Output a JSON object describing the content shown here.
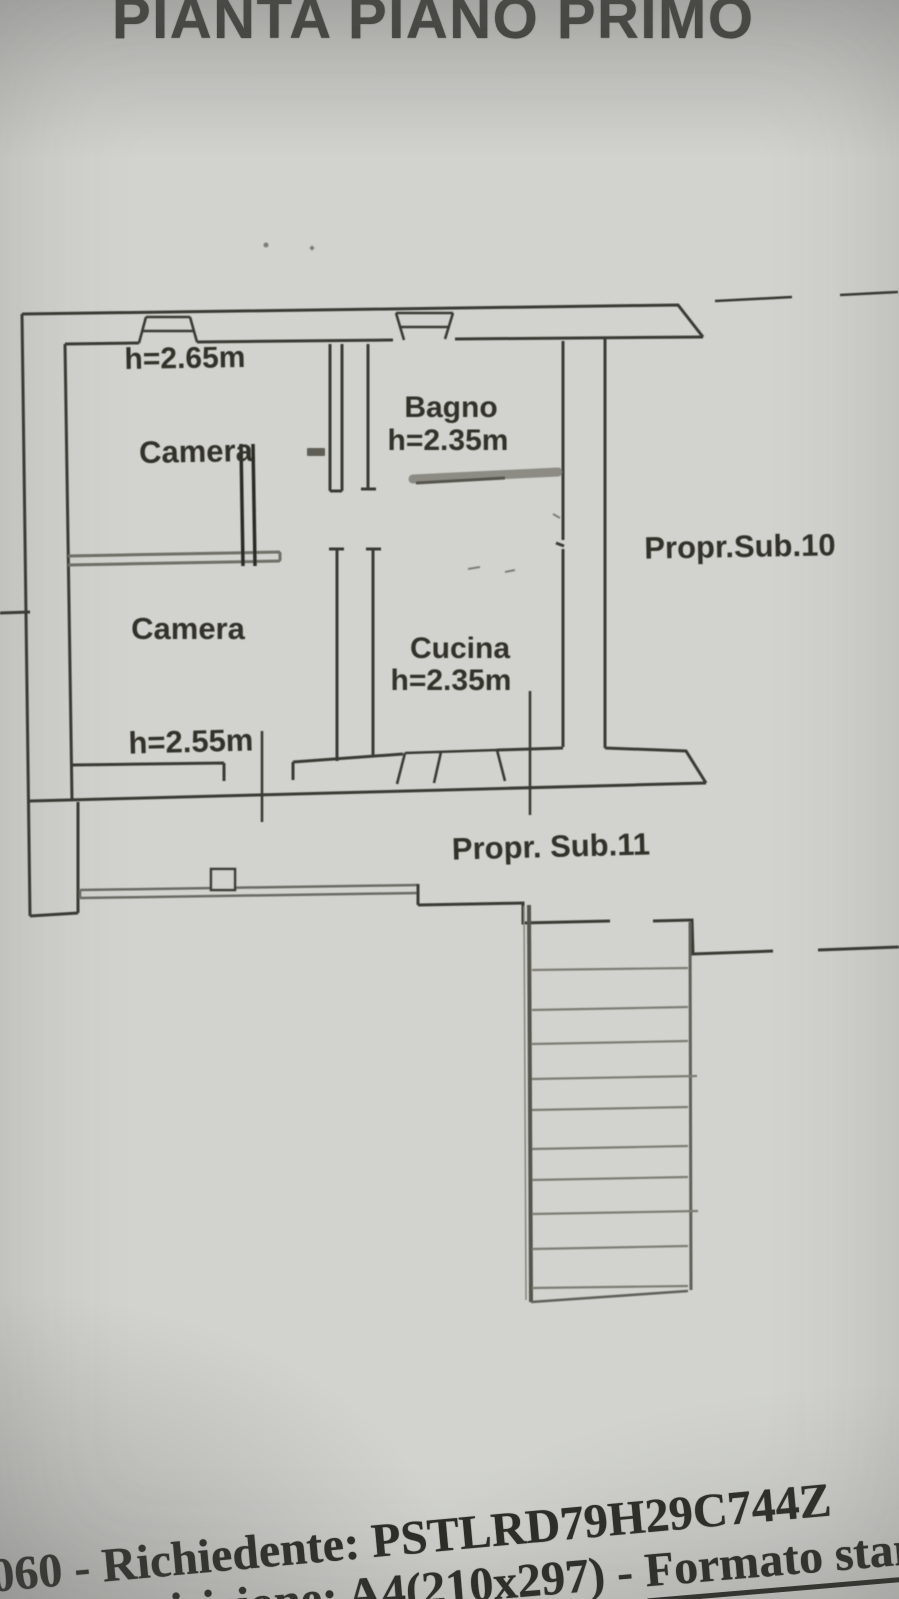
{
  "document": {
    "title": "PIANTA PIANO PRIMO",
    "footer": {
      "line1": "060 - Richiedente: PSTLRD79H29C744Z",
      "line2_prefix": "di acquisizione: A4(210x297)  - ",
      "line2_underlined": "Formato stampa"
    }
  },
  "floorplan": {
    "rooms": [
      {
        "id": "camera-top",
        "name": "Camera",
        "height_label": "h=2.65m"
      },
      {
        "id": "bagno",
        "name": "Bagno",
        "height_label": "h=2.35m"
      },
      {
        "id": "camera-bottom",
        "name": "Camera",
        "height_label": "h=2.55m"
      },
      {
        "id": "cucina",
        "name": "Cucina",
        "height_label": "h=2.35m"
      }
    ],
    "properties": [
      {
        "id": "sub10",
        "label": "Propr.Sub.10"
      },
      {
        "id": "sub11",
        "label": "Propr. Sub.11"
      }
    ],
    "colors": {
      "paper": "#d2d3ce",
      "ink": "#3b3b35",
      "pencil": "#6f6f68"
    }
  }
}
